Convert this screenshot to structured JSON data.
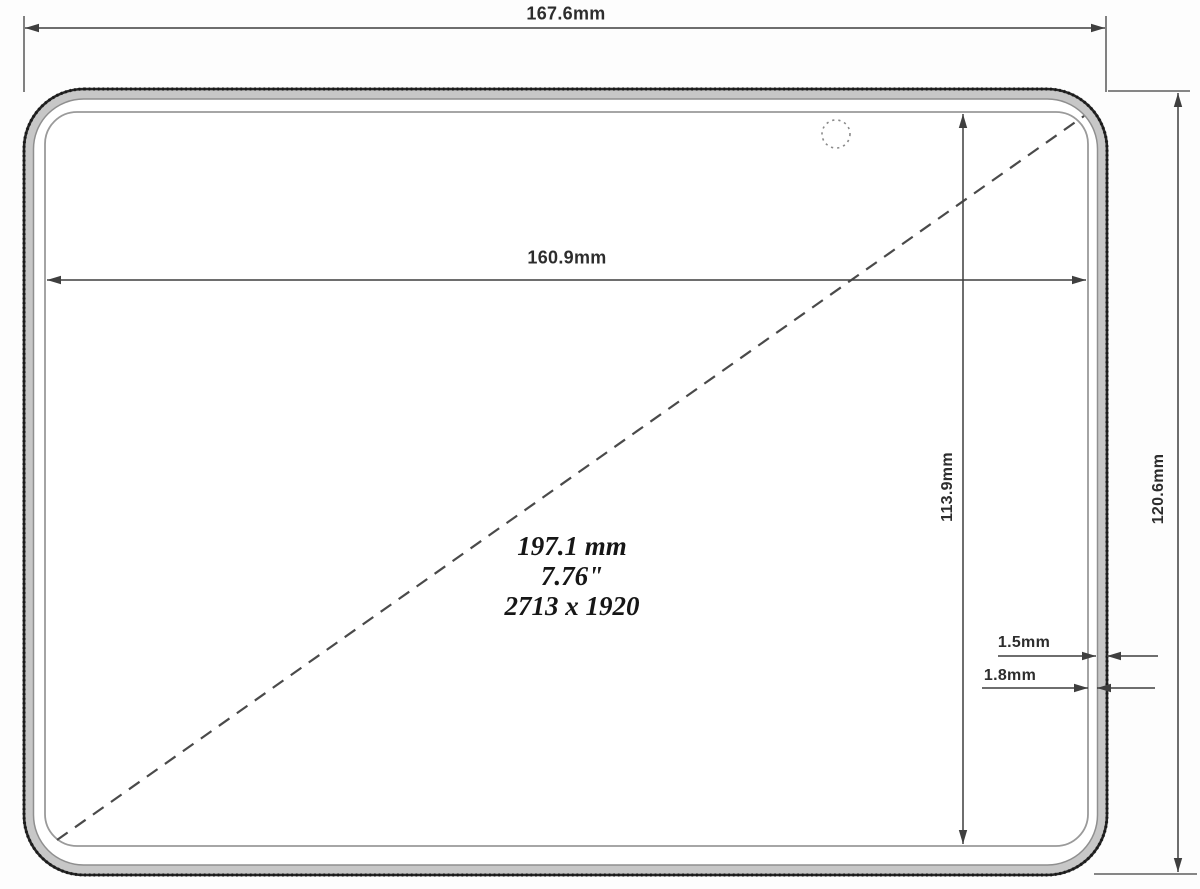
{
  "drawing": {
    "title": "tablet-display-dimension-drawing",
    "labels": {
      "outer_width": "167.6mm",
      "display_width": "160.9mm",
      "display_height": "113.9mm",
      "outer_height": "120.6mm",
      "bezel_wall": "1.5mm",
      "bezel_gap": "1.8mm",
      "diagonal_mm": "197.1 mm",
      "diagonal_inches": "7.76\"",
      "resolution": "2713 x 1920"
    },
    "dimensions_mm": {
      "outer_width": 167.6,
      "display_width": 160.9,
      "display_height": 113.9,
      "outer_height": 120.6,
      "bezel_wall": 1.5,
      "bezel_gap": 1.8,
      "diagonal_mm": 197.1,
      "diagonal_inches": 7.76
    },
    "resolution_px": {
      "width": 2713,
      "height": 1920
    },
    "colors": {
      "background": "#fdfdfd",
      "dimension_line": "#3f3f3f",
      "device_edge": "#262626",
      "mid_frame_line": "#8f8f8f",
      "display_edge": "#9a9a9a",
      "bezel_band": "#c7c7c7",
      "text": "#2d2d2d"
    }
  }
}
